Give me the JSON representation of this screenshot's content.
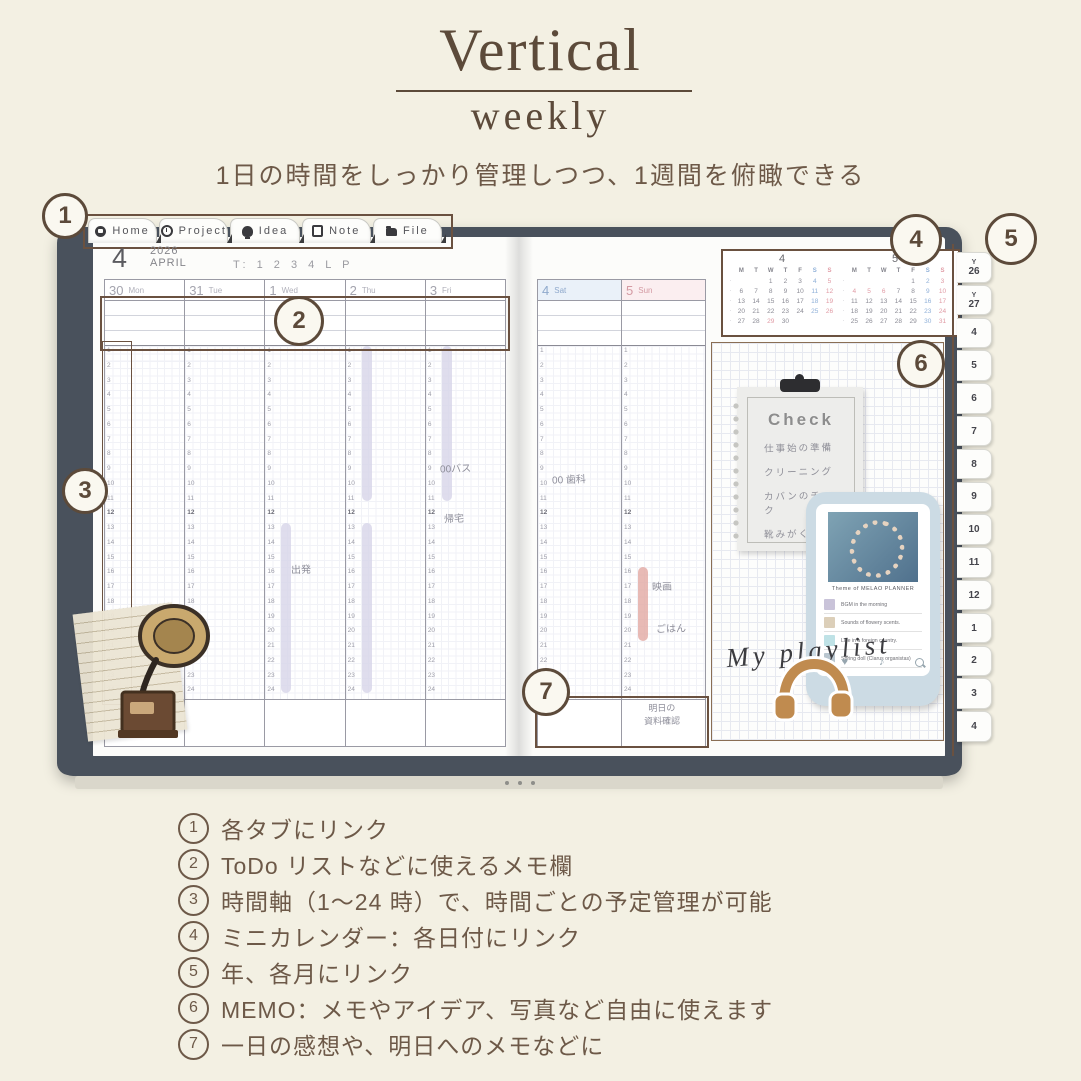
{
  "header": {
    "title": "Vertical",
    "subtitle": "weekly",
    "tagline": "1日の時間をしっかり管理しつつ、1週間を俯瞰できる"
  },
  "planner": {
    "nav_tabs": [
      {
        "icon": "home-icon",
        "label": "Home"
      },
      {
        "icon": "project-icon",
        "label": "Project"
      },
      {
        "icon": "idea-icon",
        "label": "Idea"
      },
      {
        "icon": "note-icon",
        "label": "Note"
      },
      {
        "icon": "file-icon",
        "label": "File"
      }
    ],
    "month": {
      "num": "4",
      "year": "2026",
      "name": "APRIL",
      "tracker": "T: 1 2 3 4 L P"
    },
    "hours": [
      "1",
      "2",
      "3",
      "4",
      "5",
      "6",
      "7",
      "8",
      "9",
      "10",
      "11",
      "12",
      "13",
      "14",
      "15",
      "16",
      "17",
      "18",
      "19",
      "20",
      "21",
      "22",
      "23",
      "24"
    ],
    "week": {
      "left_days": [
        {
          "date": "30",
          "dow": "Mon",
          "key": "mon"
        },
        {
          "date": "31",
          "dow": "Tue",
          "key": "tue"
        },
        {
          "date": "1",
          "dow": "Wed",
          "key": "wed"
        },
        {
          "date": "2",
          "dow": "Thu",
          "key": "thu"
        },
        {
          "date": "3",
          "dow": "Fri",
          "key": "fri"
        }
      ],
      "right_days": [
        {
          "date": "4",
          "dow": "Sat",
          "key": "sat",
          "cls": "sat"
        },
        {
          "date": "5",
          "dow": "Sun",
          "key": "sun",
          "cls": "sun"
        }
      ],
      "right_footer_note": "明日の\n資料確認"
    },
    "entries": [
      {
        "text": "00バス",
        "col": "fri",
        "hour": 8.7,
        "dx": 14
      },
      {
        "text": "帰宅",
        "col": "fri",
        "hour": 12.1,
        "dx": 18
      },
      {
        "text": "出発",
        "col": "wed",
        "hour": 15.6,
        "dx": 26
      },
      {
        "text": "00 歯科",
        "col": "sat",
        "hour": 9.5,
        "dx": 14
      },
      {
        "text": "映画",
        "col": "sun",
        "hour": 16.7,
        "dx": 30
      },
      {
        "text": "ごはん",
        "col": "sun",
        "hour": 19.6,
        "dx": 34
      }
    ],
    "highlights": [
      {
        "col": "thu",
        "from": 1,
        "to": 11.5,
        "color": "#d7d5e8"
      },
      {
        "col": "fri",
        "from": 1,
        "to": 11.5,
        "color": "#d7d5e8"
      },
      {
        "col": "wed",
        "from": 13,
        "to": 24.5,
        "color": "#d7d5e8"
      },
      {
        "col": "thu",
        "from": 13,
        "to": 24.5,
        "color": "#d7d5e8"
      },
      {
        "col": "sun",
        "from": 16,
        "to": 21,
        "color": "#e2a9a2"
      }
    ],
    "calendars": [
      {
        "title": "4",
        "dows": [
          "M",
          "T",
          "W",
          "T",
          "F",
          "S",
          "S"
        ],
        "weeks": [
          [
            "",
            "",
            "1",
            "2",
            "3",
            "4",
            "5"
          ],
          [
            "6",
            "7",
            "8",
            "9",
            "10",
            "11",
            "12"
          ],
          [
            "13",
            "14",
            "15",
            "16",
            "17",
            "18",
            "19"
          ],
          [
            "20",
            "21",
            "22",
            "23",
            "24",
            "25",
            "26"
          ],
          [
            "27",
            "28",
            "29",
            "30",
            "",
            "",
            ""
          ]
        ],
        "holidays": [
          "29"
        ],
        "week_marker": "·"
      },
      {
        "title": "5",
        "dows": [
          "M",
          "T",
          "W",
          "T",
          "F",
          "S",
          "S"
        ],
        "weeks": [
          [
            "",
            "",
            "",
            "",
            "1",
            "2",
            "3"
          ],
          [
            "4",
            "5",
            "6",
            "7",
            "8",
            "9",
            "10"
          ],
          [
            "11",
            "12",
            "13",
            "14",
            "15",
            "16",
            "17"
          ],
          [
            "18",
            "19",
            "20",
            "21",
            "22",
            "23",
            "24"
          ],
          [
            "25",
            "26",
            "27",
            "28",
            "29",
            "30",
            "31"
          ]
        ],
        "holidays": [
          "4",
          "5",
          "6"
        ],
        "week_marker": "·"
      }
    ],
    "calendar_colors": {
      "sat": "#8fb0d8",
      "sun": "#e09aa4",
      "day": "#8b8b95"
    },
    "check_note": {
      "title": "Check",
      "items": [
        "仕事始の準備",
        "クリーニング",
        "カバンのチェック",
        "靴みがく"
      ]
    },
    "phone": {
      "album_caption": "Theme of MELAO PLANNER",
      "tracks": [
        {
          "title": "BGM in the morning",
          "thumb": "#c9c3d9"
        },
        {
          "title": "Sounds of flowery scents.",
          "thumb": "#dccfb9"
        },
        {
          "title": "Like in a foreign country.",
          "thumb": "#bfe2e6"
        },
        {
          "title": "Spring doll (Clarus organistas)",
          "thumb": "#b9c6cf"
        }
      ],
      "dock_icons": [
        "heart-icon",
        "music-note-icon",
        "search-icon"
      ],
      "dock_glyphs": {
        "heart": "♥",
        "note": "♪"
      }
    },
    "playlist_label": "My playlist",
    "side_tabs": [
      {
        "top": "Y",
        "num": "26"
      },
      {
        "top": "Y",
        "num": "27"
      },
      {
        "num": "4"
      },
      {
        "num": "5"
      },
      {
        "num": "6"
      },
      {
        "num": "7"
      },
      {
        "num": "8"
      },
      {
        "num": "9"
      },
      {
        "num": "10"
      },
      {
        "num": "11"
      },
      {
        "num": "12"
      },
      {
        "num": "1"
      },
      {
        "num": "2"
      },
      {
        "num": "3"
      },
      {
        "num": "4"
      }
    ]
  },
  "annotations": [
    "1",
    "2",
    "3",
    "4",
    "5",
    "6",
    "7"
  ],
  "legend": [
    {
      "num": "1",
      "text": "各タブにリンク"
    },
    {
      "num": "2",
      "text": "ToDo リストなどに使えるメモ欄"
    },
    {
      "num": "3",
      "text": "時間軸（1～24 時）で、時間ごとの予定管理が可能"
    },
    {
      "num": "4",
      "text": "ミニカレンダー：各日付にリンク"
    },
    {
      "num": "5",
      "text": "年、各月にリンク"
    },
    {
      "num": "6",
      "text": "MEMO：メモやアイデア、写真など自由に使えます"
    },
    {
      "num": "7",
      "text": "一日の感想や、明日へのメモなどに"
    }
  ],
  "colors": {
    "background": "#f3f0e3",
    "accent_brown": "#5c4a3a",
    "cover": "#49515c",
    "highlight_lavender": "#d7d5e8",
    "highlight_pink": "#e2a9a2"
  }
}
